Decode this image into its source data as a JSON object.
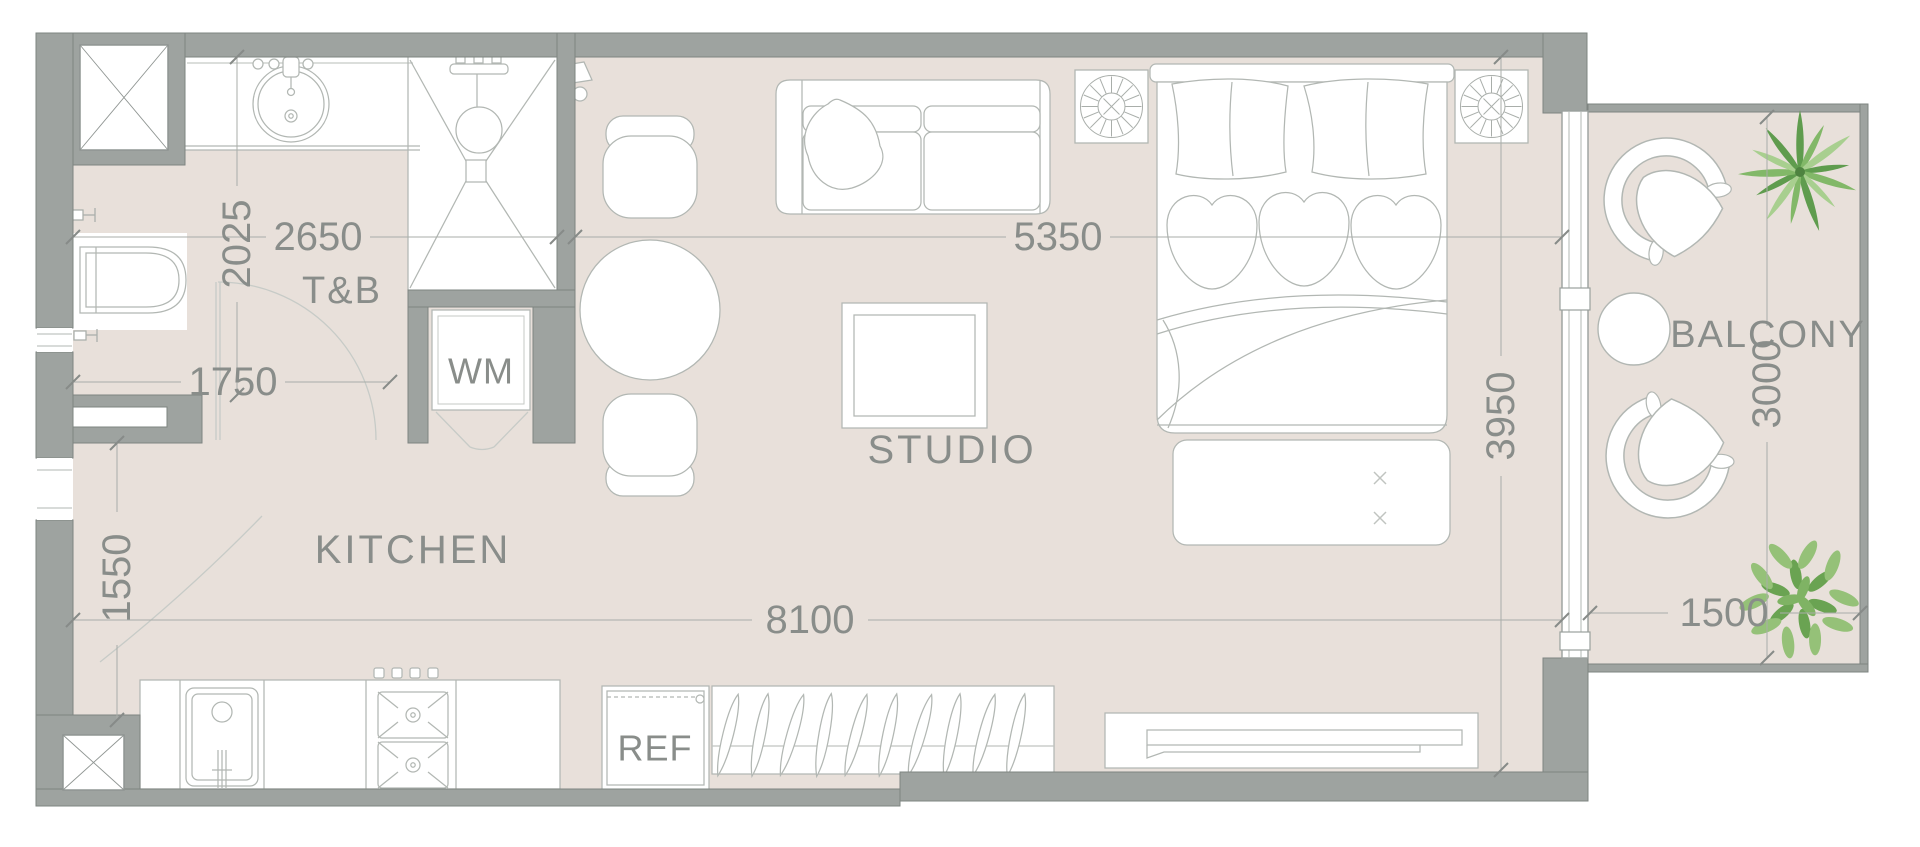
{
  "colors": {
    "background": "#ffffff",
    "floor": "#e8e0da",
    "wall_fill": "#9ea3a0",
    "wall_edge": "#7e8481",
    "furniture_line": "#b2b7b3",
    "dimension_line": "#a9ada9",
    "text": "#898d8a",
    "plant_green_dark": "#6aa352",
    "plant_green_light": "#95c178"
  },
  "rooms": {
    "bathroom": {
      "label": "T&B"
    },
    "kitchen": {
      "label": "KITCHEN"
    },
    "studio": {
      "label": "STUDIO"
    },
    "balcony": {
      "label": "BALCONY"
    }
  },
  "appliances": {
    "washing_machine": {
      "label": "WM"
    },
    "refrigerator": {
      "label": "REF"
    }
  },
  "dimensions_mm": {
    "bathroom_depth": "2025",
    "bathroom_width": "2650",
    "hallway_width": "1750",
    "kitchen_depth": "1550",
    "studio_width": "5350",
    "studio_depth": "3950",
    "unit_length": "8100",
    "balcony_depth": "3000",
    "balcony_width": "1500"
  },
  "icons": {
    "ceiling_fan": "round exhaust-fan symbol in square box",
    "shaft": "white box with X cross",
    "palm_plant": "palm frond plan symbol",
    "shrub_plant": "leafy shrub plan symbol"
  }
}
